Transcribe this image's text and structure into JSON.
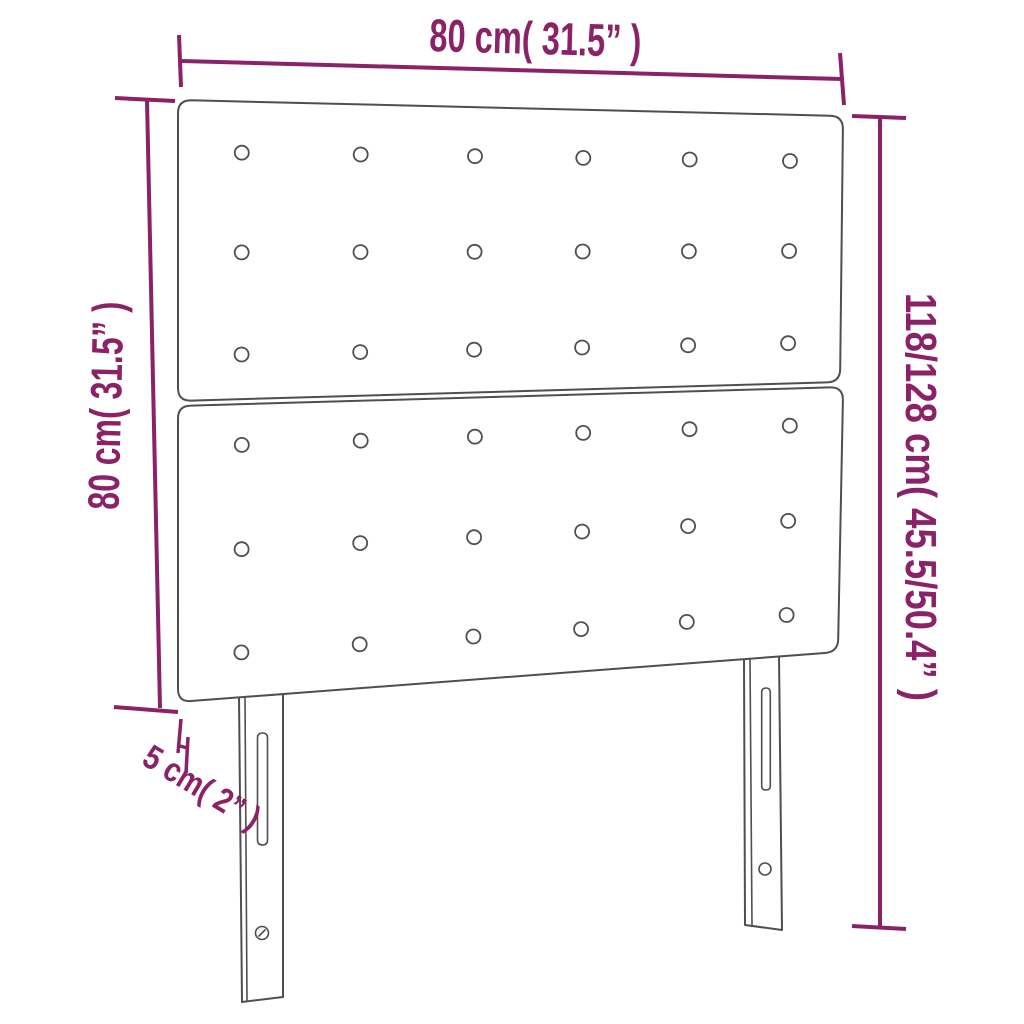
{
  "page": {
    "background": "#ffffff"
  },
  "diagram": {
    "type": "furniture-dimension-diagram",
    "subject": "upholstered headboard with tufted buttons and two slotted legs",
    "colors": {
      "dimension": "#8b2167",
      "outline": "#4f4f4f",
      "background": "#ffffff"
    },
    "labels": {
      "top_width": "80 cm( 31.5” )",
      "left_height": "80 cm( 31.5” )",
      "right_total_height": "118/128 cm( 45.5/50.4” )",
      "bottom_thickness": "5 cm( 2” )"
    },
    "panels": [
      {
        "name": "upper panel",
        "button_rows": 3,
        "button_cols": 6,
        "buttons": 18
      },
      {
        "name": "lower panel",
        "button_rows": 3,
        "button_cols": 6,
        "buttons": 18
      }
    ],
    "legs": [
      {
        "name": "left leg",
        "slots": 1,
        "screw_holes": 1
      },
      {
        "name": "right leg",
        "slots": 1,
        "screw_holes": 1
      }
    ]
  }
}
